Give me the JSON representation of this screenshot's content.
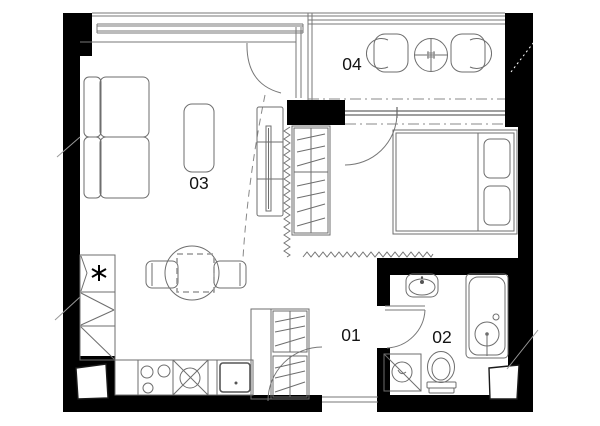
{
  "plan": {
    "rooms": [
      {
        "label": "01"
      },
      {
        "label": "02"
      },
      {
        "label": "03"
      },
      {
        "label": "04"
      }
    ],
    "icons": {
      "fridge": "asterisk-snowflake-icon",
      "balcony_table_center": "hash-icon"
    },
    "colors": {
      "wall": "#000000",
      "furniture_line": "#6e6e6e",
      "window_line": "#777777",
      "hatch_line": "#888888",
      "label_text": "#141414",
      "background": "#ffffff"
    }
  }
}
